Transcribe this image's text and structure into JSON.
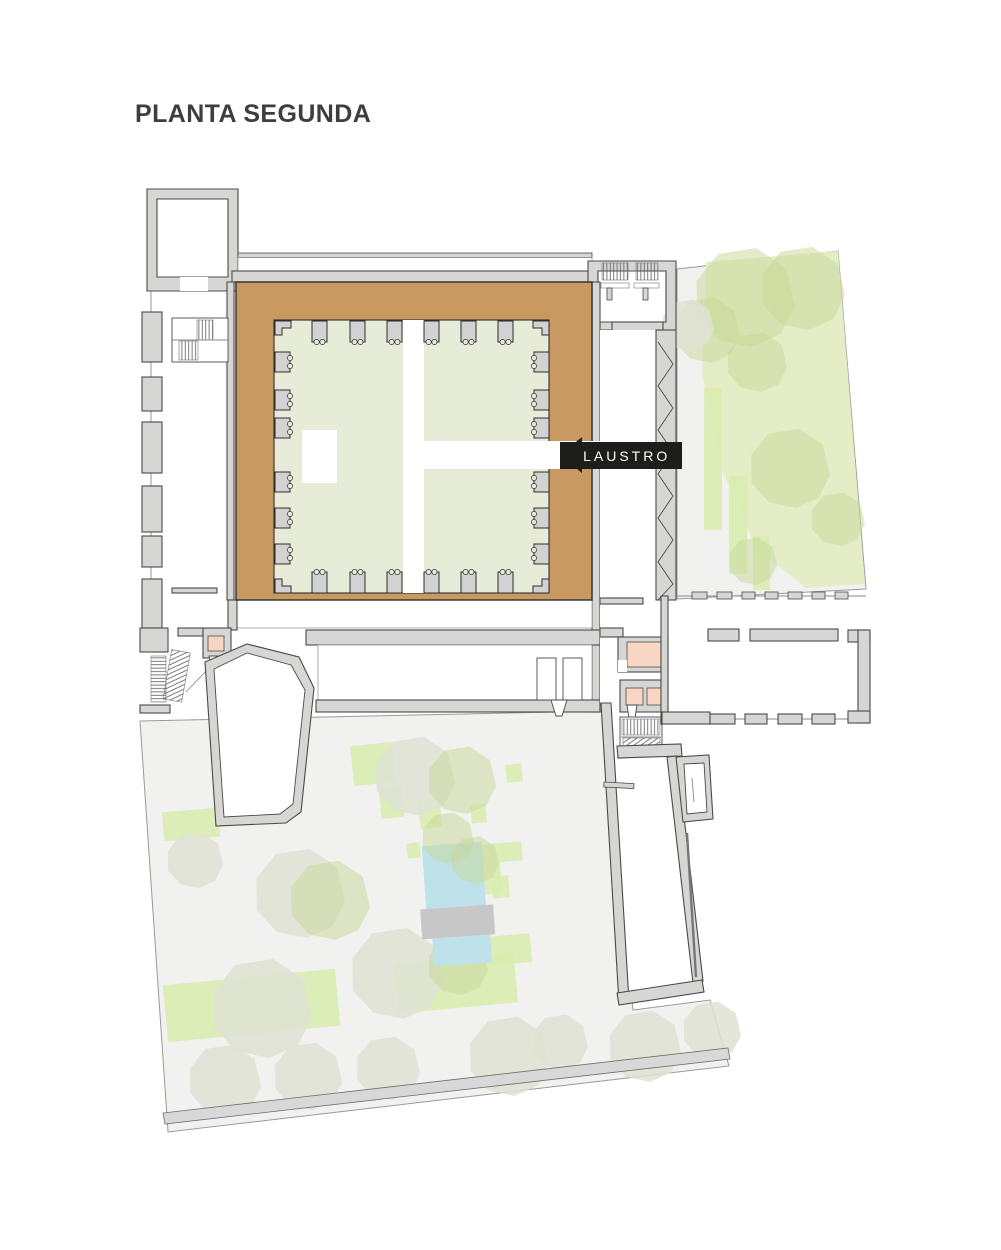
{
  "page": {
    "title": "PLANTA SEGUNDA"
  },
  "plan": {
    "floor_label": "PLANTA SEGUNDA",
    "annotations": [
      {
        "text": "CLAUSTRO",
        "target": "cloister-gallery",
        "style": "black-tag-with-left-arrow"
      }
    ],
    "features": {
      "highlighted_area": "cloister gallery (brown)",
      "courtyard": "central green courtyard with columns",
      "gardens": [
        "north-east garden",
        "south garden with pool"
      ],
      "pool": "light blue pool crossed by gray footbridge"
    }
  },
  "colors": {
    "title_text": "#3e3e3e",
    "wall_fill": "#d6d6d5",
    "wall_stroke": "#4a4a4a",
    "outline_dark": "#2e2e2e",
    "room_white": "#ffffff",
    "cloister_brown": "#c89a62",
    "courtyard_green": "#e7ecd8",
    "column_gray": "#d2d2d2",
    "garden_gray": "#f1f1f0",
    "garden_green": "#e5edc7",
    "hedge_green": "#d9ecae",
    "tree_green": "#c7d898",
    "tree_sage": "#dfe2d4",
    "pool_blue": "#bfe2ea",
    "bridge_gray": "#c7c7c7",
    "room_pink": "#f9d6c3",
    "label_bg": "#1d1d1b",
    "label_text": "#ffffff"
  }
}
